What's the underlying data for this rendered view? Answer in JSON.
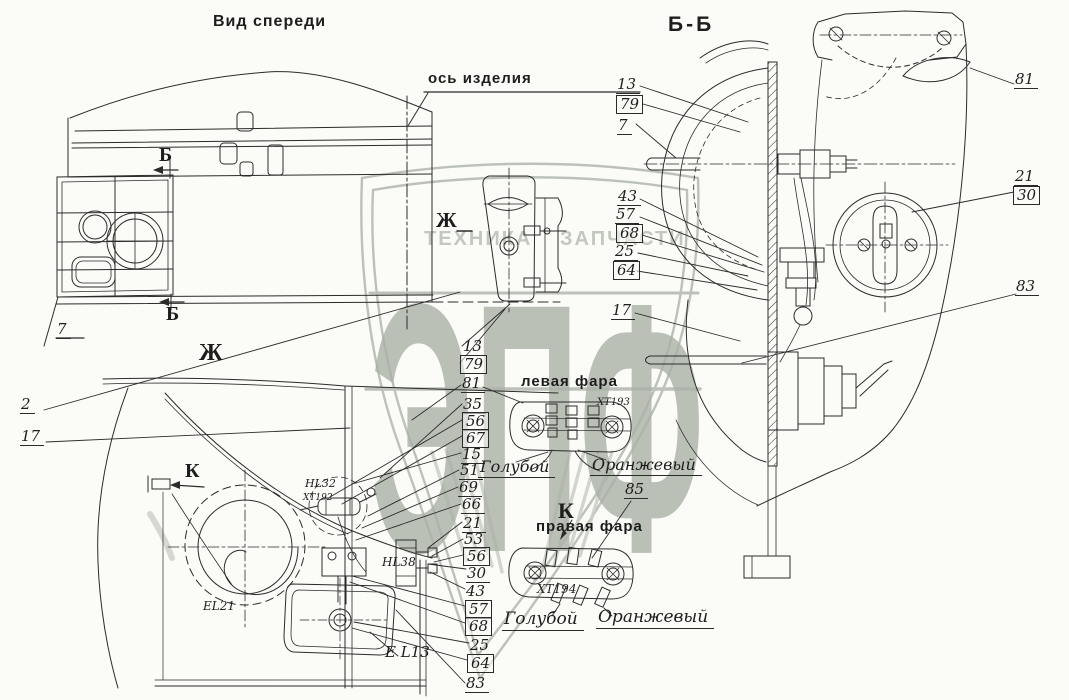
{
  "titles": {
    "front_view": "Вид спереди",
    "section": "Б-Б",
    "axis": "ось изделия",
    "left_fara": "левая фара",
    "right_fara": "правая фара"
  },
  "markers": {
    "b": "Б",
    "zh": "Ж",
    "k": "К"
  },
  "watermark": {
    "left": "ТЕХНИКА",
    "right": "ЗАПЧАСТИ",
    "logo": "ЭПФ"
  },
  "callouts": {
    "front": [
      "2",
      "17",
      "7"
    ],
    "bb_top": [
      "13",
      "79",
      "7"
    ],
    "bb_right": [
      "81",
      "21",
      "30",
      "83"
    ],
    "bb_left": [
      "43",
      "57",
      "68",
      "25",
      "64",
      "17"
    ],
    "center": [
      "13",
      "79",
      "81",
      "35",
      "56",
      "67",
      "15",
      "51",
      "69",
      "66",
      "21",
      "53",
      "56",
      "30",
      "43",
      "57",
      "68",
      "25",
      "64",
      "83"
    ],
    "fara": [
      "85"
    ]
  },
  "components": {
    "hl32": "HL32",
    "xt_hl32": "XT192",
    "el21": "EL21",
    "hl38": "HL38",
    "el13": "E L13",
    "xt_left": "XT193",
    "xt_right": "XT194"
  },
  "wires": {
    "left": {
      "blue": "Голубой",
      "orange": "Оранжевый"
    },
    "right": {
      "blue": "Голубой",
      "orange": "Оранжевый"
    }
  },
  "colors": {
    "ink": "#2b2b2b",
    "paper": "#fbfbf8",
    "watermark": "#b5bbb1",
    "watermark_letters": "#a9b0a5",
    "watermark_text": "#c3c8be"
  }
}
